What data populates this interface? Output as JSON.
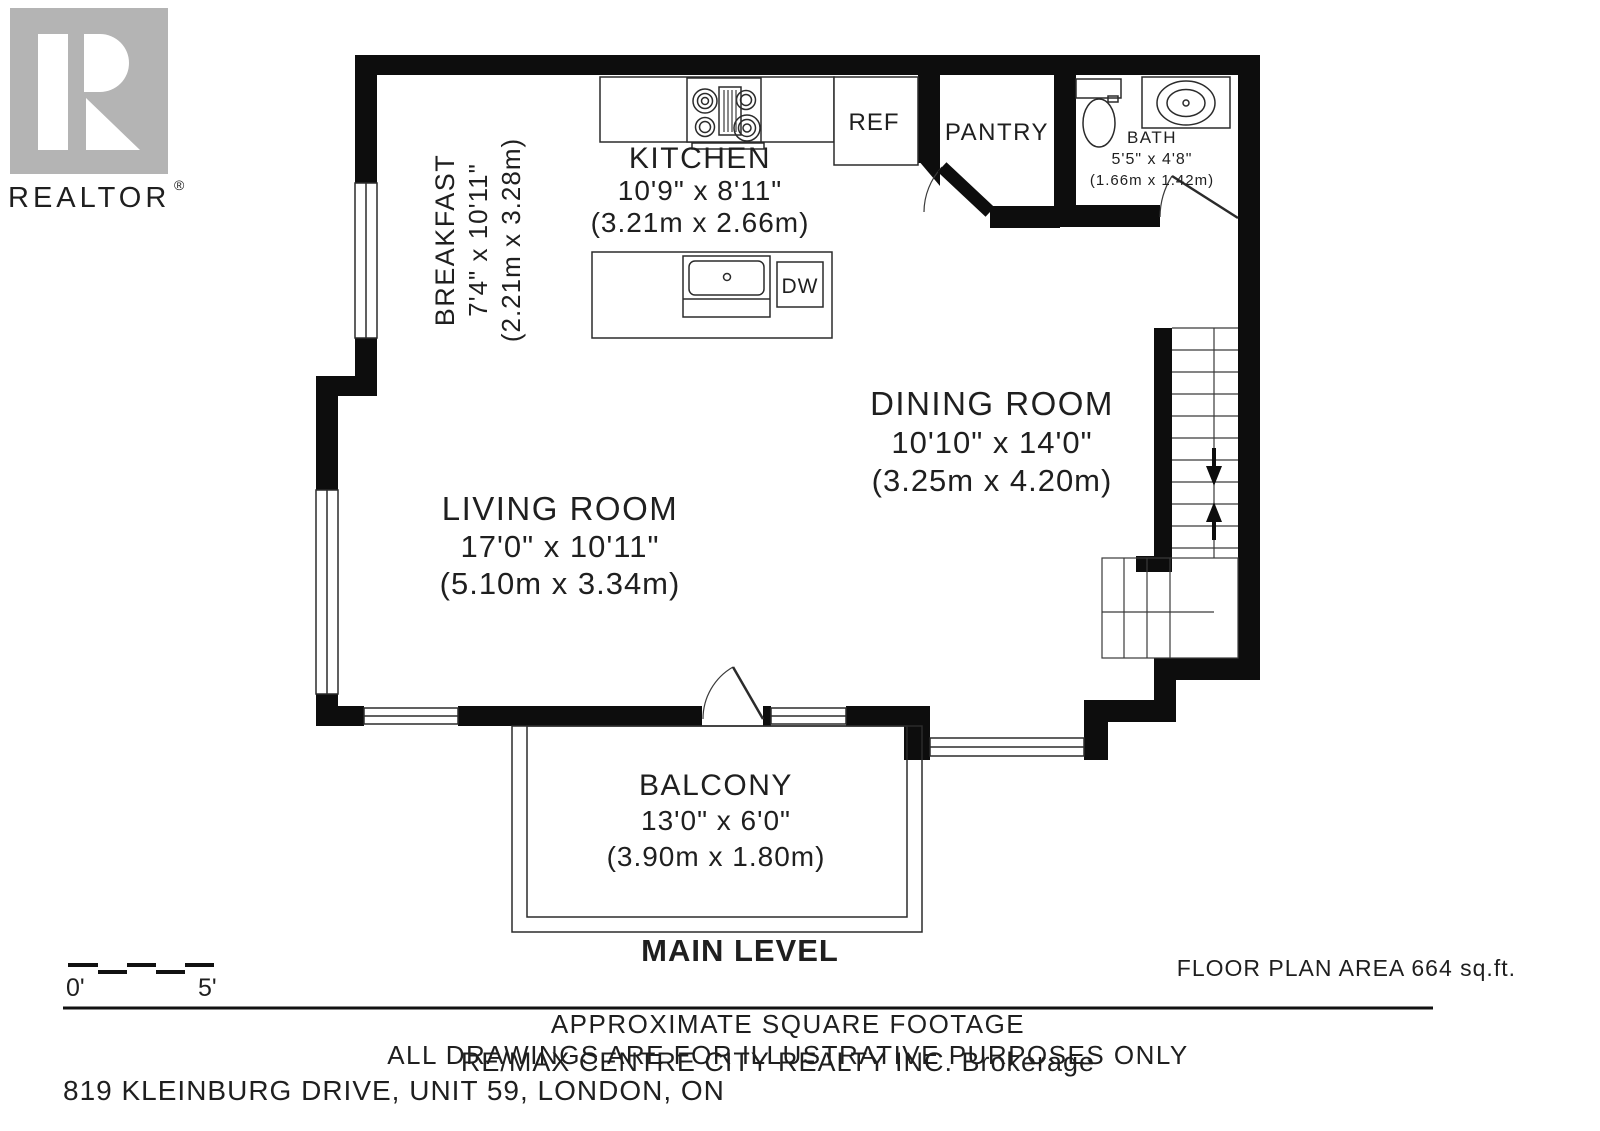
{
  "branding": {
    "logo_text": "REALTOR",
    "registered": "®"
  },
  "rooms": {
    "breakfast": {
      "name": "BREAKFAST",
      "imperial": "7'4\" x 10'11\"",
      "metric": "(2.21m x 3.28m)"
    },
    "kitchen": {
      "name": "KITCHEN",
      "imperial": "10'9\" x 8'11\"",
      "metric": "(3.21m x 2.66m)"
    },
    "dining": {
      "name": "DINING ROOM",
      "imperial": "10'10\" x 14'0\"",
      "metric": "(3.25m x 4.20m)"
    },
    "living": {
      "name": "LIVING ROOM",
      "imperial": "17'0\" x 10'11\"",
      "metric": "(5.10m x 3.34m)"
    },
    "balcony": {
      "name": "BALCONY",
      "imperial": "13'0\" x 6'0\"",
      "metric": "(3.90m x 1.80m)"
    },
    "bath": {
      "name": "BATH",
      "imperial": "5'5\" x 4'8\"",
      "metric": "(1.66m x 1.42m)"
    },
    "pantry": {
      "name": "PANTRY"
    }
  },
  "labels": {
    "ref": "REF",
    "dw": "DW"
  },
  "scale_bar": {
    "start": "0'",
    "end": "5'"
  },
  "footer": {
    "level_title": "MAIN LEVEL",
    "floor_area": "FLOOR PLAN AREA 664 sq.ft.",
    "disclaimer_line1": "APPROXIMATE SQUARE FOOTAGE",
    "disclaimer_line2": "ALL DRAWINGS ARE FOR ILLUSTRATIVE PURPOSES ONLY",
    "watermark": "RE/MAX CENTRE CITY REALTY INC. Brokerage",
    "address": "819 KLEINBURG DRIVE, UNIT 59, LONDON, ON"
  },
  "colors": {
    "wall": "#0d0d0d",
    "line": "#2b2b2b",
    "logo_gray": "#b4b4b4",
    "muted_text": "#7d7d7d",
    "watermark": "#cdcdcd",
    "text": "#1f1f1f"
  }
}
